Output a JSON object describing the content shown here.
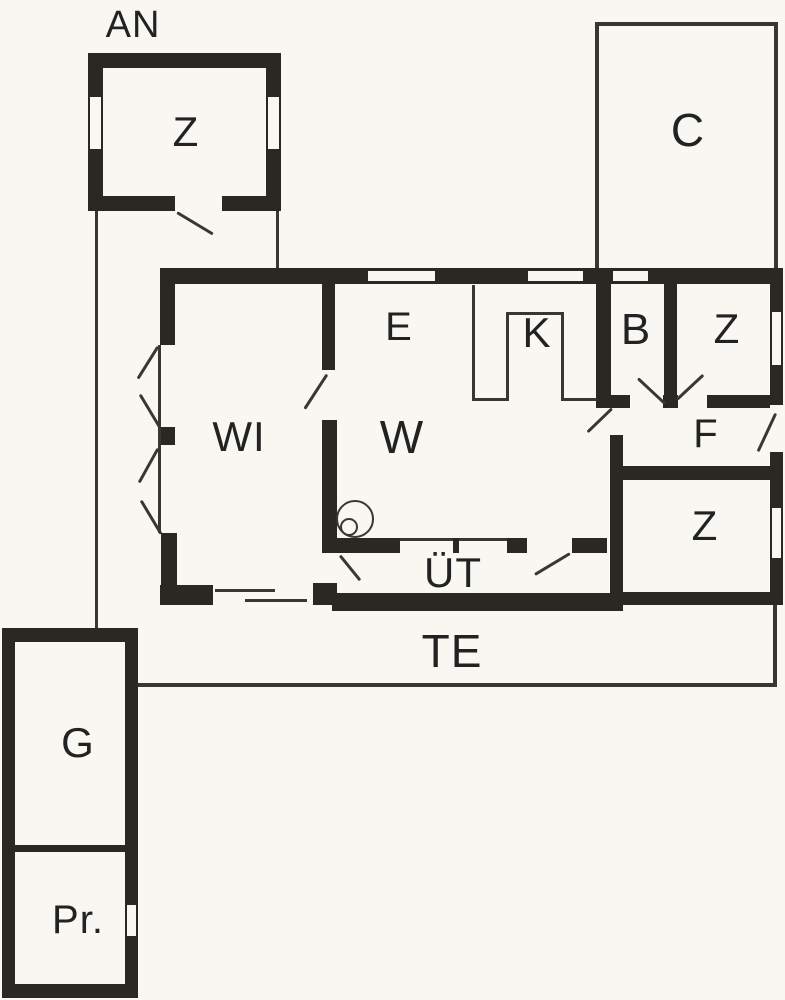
{
  "plan": {
    "colors": {
      "background": "#f8f7f2",
      "wall": "#2b2723",
      "line": "#3a3633",
      "text": "#222222"
    },
    "labels": {
      "annex": "AN",
      "annex_room": "Z",
      "carport": "C",
      "dining": "E",
      "kitchen": "K",
      "bath": "B",
      "bedroom_top": "Z",
      "winter_garden": "WI",
      "living": "W",
      "hall": "F",
      "bedroom_right": "Z",
      "covered_porch": "ÜT",
      "terrace": "TE",
      "garage": "G",
      "storage": "Pr."
    }
  }
}
